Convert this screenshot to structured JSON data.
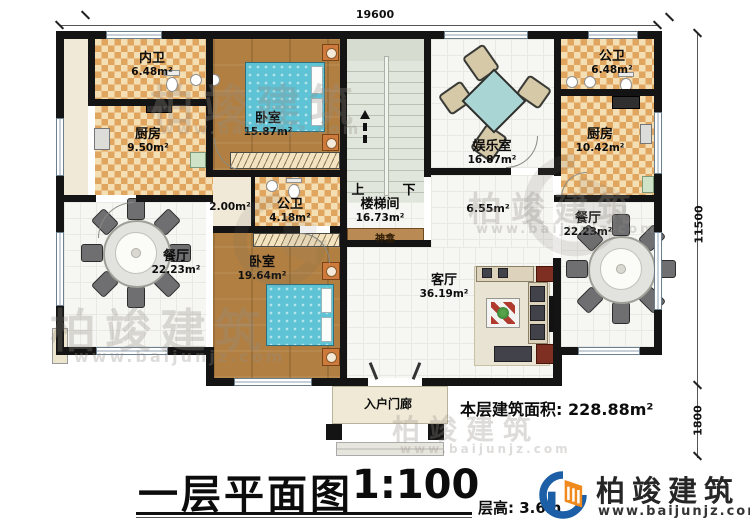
{
  "plan": {
    "dim_top": "19600",
    "dim_right_main": "11500",
    "dim_right_porch": "1800",
    "rooms": [
      {
        "name": "内卫",
        "area": "6.48m²"
      },
      {
        "name": "厨房",
        "area": "9.50m²"
      },
      {
        "name": "卧室",
        "area": "15.87m²"
      },
      {
        "name": "公卫",
        "area": "6.48m²"
      },
      {
        "name": "厨房",
        "area": "10.42m²"
      },
      {
        "name": "公卫",
        "area": "4.18m²"
      },
      {
        "name": "楼梯间",
        "area": "16.73m²"
      },
      {
        "name": "餐厅",
        "area": "22.23m²"
      },
      {
        "name": "卧室",
        "area": "19.64m²"
      },
      {
        "name": "客厅",
        "area": "36.19m²"
      },
      {
        "name": "餐厅",
        "area": "22.23m²"
      },
      {
        "name": "娱乐室",
        "area": "16.87m²"
      }
    ],
    "closet_area": "2.00m²",
    "hall_area": "6.55m²",
    "shrine": "神龛",
    "porch": "入户门廊",
    "stair_up": "上",
    "stair_down": "下"
  },
  "titleblock": {
    "title": "一层平面图",
    "scale": "1:100",
    "floor_height": "层高: 3.6m",
    "floor_area_label": "本层建筑面积:",
    "floor_area_value": "228.88m²"
  },
  "brand": {
    "name": "柏竣建筑",
    "site": "www.baijunjz.com"
  },
  "watermark": {
    "text": "柏竣建筑",
    "site": "www.baijunjz.com"
  },
  "colors": {
    "wall": "#141414",
    "accent_blue": "#1d5fa6",
    "accent_orange": "#f08a1e",
    "checker_tile": "#e0a55f",
    "wood": "#b17f41",
    "bed": "#5fc3d6"
  }
}
